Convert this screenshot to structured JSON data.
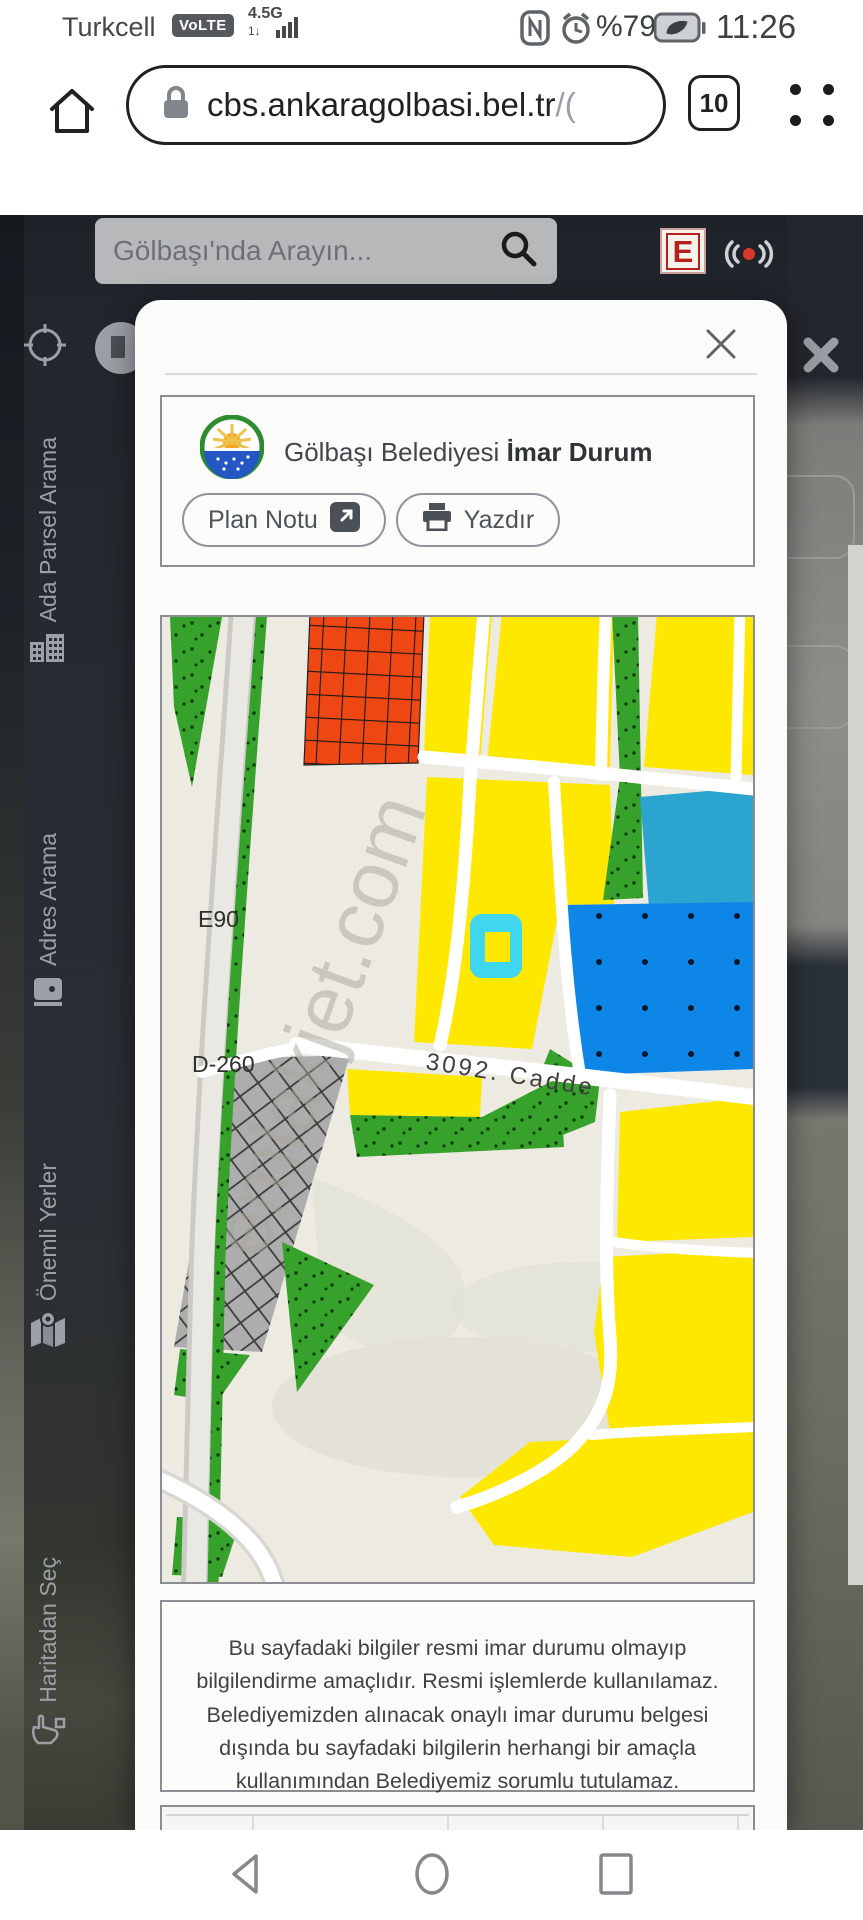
{
  "status_bar": {
    "carrier": "Turkcell",
    "volte_badge": "VoLTE",
    "network": "4.5G",
    "network_sub": "1↓",
    "battery_percent": "%79",
    "time": "11:26"
  },
  "browser": {
    "url": "cbs.ankaragolbasi.bel.tr",
    "url_suffix": "/(",
    "tab_count": "10"
  },
  "page": {
    "search_placeholder": "Gölbaşı'nda Arayın...",
    "pharmacy_badge": "E"
  },
  "sidebar": {
    "items": [
      {
        "label": "Ada Parsel Arama"
      },
      {
        "label": "Adres Arama"
      },
      {
        "label": "Önemli Yerler"
      },
      {
        "label": "Haritadan Seç"
      }
    ]
  },
  "modal": {
    "title_prefix": "Gölbaşı Belediyesi ",
    "title_bold": "İmar Durum",
    "plan_notu_label": "Plan Notu",
    "yazdir_label": "Yazdır",
    "disclaimer": "Bu sayfadaki bilgiler resmi imar durumu olmayıp bilgilendirme amaçlıdır. Resmi işlemlerde kullanılamaz. Belediyemizden alınacak onaylı imar durumu belgesi dışında bu sayfadaki bilgilerin herhangi bir amaçla kullanımından Belediyemiz sorumlu tutulamaz."
  },
  "map": {
    "labels": {
      "highway": "E90",
      "road": "D-260",
      "street": "3092. Cadde"
    },
    "watermark": "emlakjet.com",
    "colors": {
      "parcel_yellow": "#FFE800",
      "selected_cyan": "#3FD6EF",
      "water_blue": "#0E86E8",
      "teal": "#2BA4CF",
      "green": "#36A12B",
      "red_zone": "#EE4713",
      "gray_zone": "#ADADAD",
      "background": "#ECEAE1"
    }
  }
}
